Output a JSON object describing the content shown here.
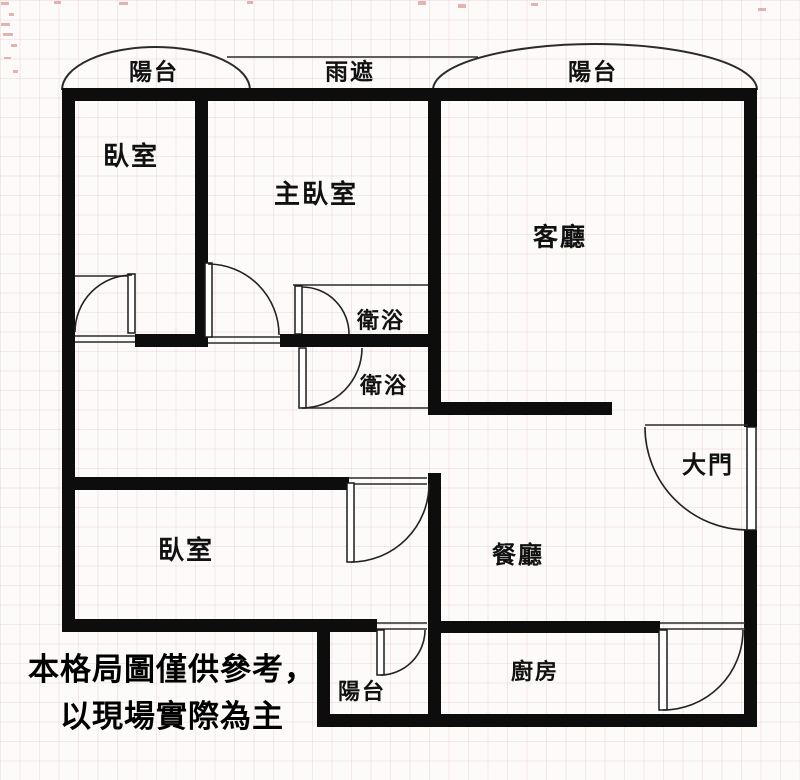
{
  "labels": {
    "balcony_top_left": "陽台",
    "rain_shield": "雨遮",
    "balcony_top_right": "陽台",
    "bedroom_upper": "臥室",
    "master_bedroom": "主臥室",
    "living_room": "客廳",
    "bathroom_upper": "衛浴",
    "bathroom_lower": "衛浴",
    "bedroom_lower": "臥室",
    "dining_room": "餐廳",
    "main_door": "大門",
    "balcony_bottom": "陽台",
    "kitchen": "廚房"
  },
  "disclaimer": {
    "line1": "本格局圖僅供參考，",
    "line2": "以現場實際為主"
  },
  "colors": {
    "wall": "#0d0d0d",
    "line": "#2b2b2b",
    "background": "#fcfbfa",
    "tick": "#c65a5a"
  }
}
